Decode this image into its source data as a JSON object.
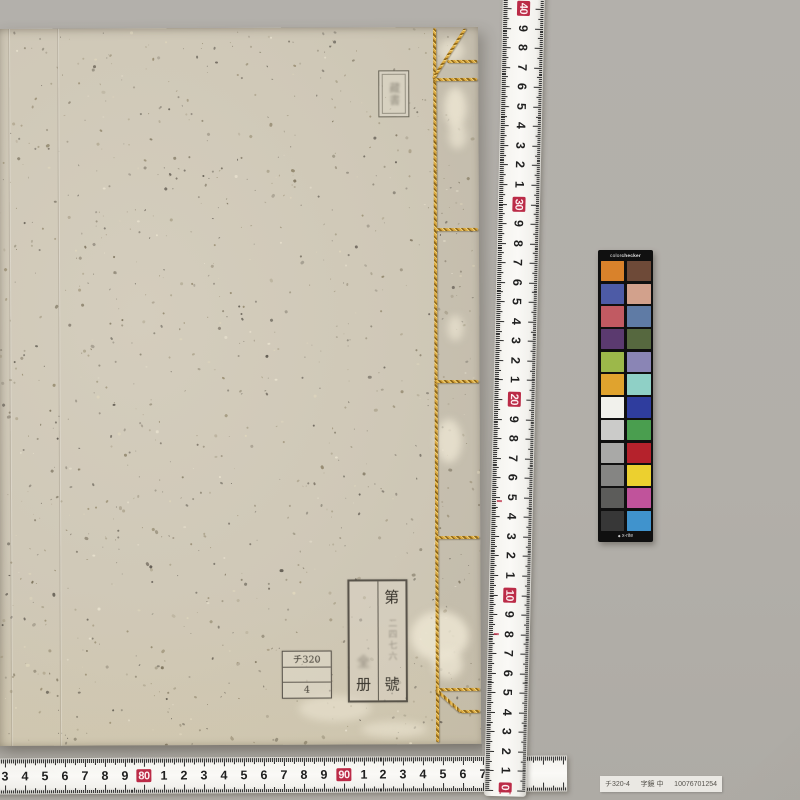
{
  "photo": {
    "background_color": "#b2afa9"
  },
  "book": {
    "cover_color": "#cfc8b7",
    "binding_thread_color": "#d8a63e",
    "ownership_stamp": {
      "text": "藏書"
    },
    "volume_label": {
      "right_column": {
        "top": "第",
        "middle_faint": "二四七六",
        "bottom": "號"
      },
      "left_column": {
        "middle_faint": "全",
        "bottom": "册"
      }
    },
    "call_number_label": {
      "row1": "チ320",
      "row2": "",
      "row3": "4"
    }
  },
  "vertical_ruler": {
    "red_color": "#bb2b47",
    "labels": [
      {
        "t": "40",
        "y": 8,
        "red": true
      },
      {
        "t": "9",
        "y": 28
      },
      {
        "t": "8",
        "y": 47
      },
      {
        "t": "7",
        "y": 67
      },
      {
        "t": "6",
        "y": 86
      },
      {
        "t": "5",
        "y": 106
      },
      {
        "t": "4",
        "y": 125
      },
      {
        "t": "3",
        "y": 145
      },
      {
        "t": "2",
        "y": 164
      },
      {
        "t": "1",
        "y": 184
      },
      {
        "t": "30",
        "y": 204,
        "red": true
      },
      {
        "t": "9",
        "y": 223
      },
      {
        "t": "8",
        "y": 243
      },
      {
        "t": "7",
        "y": 262
      },
      {
        "t": "6",
        "y": 282
      },
      {
        "t": "5",
        "y": 301
      },
      {
        "t": "4",
        "y": 321
      },
      {
        "t": "3",
        "y": 340
      },
      {
        "t": "2",
        "y": 360
      },
      {
        "t": "1",
        "y": 379
      },
      {
        "t": "20",
        "y": 399,
        "red": true
      },
      {
        "t": "9",
        "y": 419
      },
      {
        "t": "8",
        "y": 438
      },
      {
        "t": "7",
        "y": 458
      },
      {
        "t": "6",
        "y": 477
      },
      {
        "t": "5",
        "y": 497
      },
      {
        "t": "4",
        "y": 516
      },
      {
        "t": "3",
        "y": 536
      },
      {
        "t": "2",
        "y": 555
      },
      {
        "t": "1",
        "y": 575
      },
      {
        "t": "10",
        "y": 595,
        "red": true
      },
      {
        "t": "9",
        "y": 614
      },
      {
        "t": "8",
        "y": 634
      },
      {
        "t": "7",
        "y": 653
      },
      {
        "t": "6",
        "y": 673
      },
      {
        "t": "5",
        "y": 692
      },
      {
        "t": "4",
        "y": 712
      },
      {
        "t": "3",
        "y": 731
      },
      {
        "t": "2",
        "y": 751
      },
      {
        "t": "1",
        "y": 770
      }
    ]
  },
  "horizontal_ruler": {
    "red_color": "#bb2b47",
    "labels": [
      {
        "t": "3",
        "x": 5
      },
      {
        "t": "4",
        "x": 25
      },
      {
        "t": "5",
        "x": 45
      },
      {
        "t": "6",
        "x": 65
      },
      {
        "t": "7",
        "x": 85
      },
      {
        "t": "8",
        "x": 105
      },
      {
        "t": "9",
        "x": 125
      },
      {
        "t": "80",
        "x": 144,
        "red": true
      },
      {
        "t": "1",
        "x": 164
      },
      {
        "t": "2",
        "x": 184
      },
      {
        "t": "3",
        "x": 204
      },
      {
        "t": "4",
        "x": 224
      },
      {
        "t": "5",
        "x": 244
      },
      {
        "t": "6",
        "x": 264
      },
      {
        "t": "7",
        "x": 284
      },
      {
        "t": "8",
        "x": 304
      },
      {
        "t": "9",
        "x": 324
      },
      {
        "t": "90",
        "x": 344,
        "red": true
      },
      {
        "t": "1",
        "x": 364
      },
      {
        "t": "2",
        "x": 383
      },
      {
        "t": "3",
        "x": 403
      },
      {
        "t": "4",
        "x": 423
      },
      {
        "t": "5",
        "x": 443
      },
      {
        "t": "6",
        "x": 463
      },
      {
        "t": "7",
        "x": 483
      },
      {
        "t": "8",
        "x": 503
      },
      {
        "t": "9",
        "x": 523
      }
    ]
  },
  "colorchecker": {
    "title_light": "color",
    "title_bold": "checker",
    "brand_symbol": "◆",
    "brand_name": "x-rite",
    "rows": [
      [
        "#d9822b",
        "#6e4a38"
      ],
      [
        "#4d5ba6",
        "#d2a18c"
      ],
      [
        "#c15a62",
        "#5f7ba5"
      ],
      [
        "#5b3a6f",
        "#56683f"
      ],
      [
        "#9cb84a",
        "#8a85b5"
      ],
      [
        "#e0a32e",
        "#8fd0c6"
      ],
      [
        "#f1f1ec",
        "#2f3d9e"
      ],
      [
        "#cbcbc9",
        "#4a9e4f"
      ],
      [
        "#a9a9a7",
        "#b5222c"
      ],
      [
        "#858583",
        "#ecd02f"
      ],
      [
        "#5c5c5a",
        "#c0539b"
      ],
      [
        "#373737",
        "#4093cd"
      ]
    ]
  },
  "catalog_sticker": {
    "part1": "チ320-4",
    "part2": "字鏡 中",
    "part3": "10076701254"
  }
}
